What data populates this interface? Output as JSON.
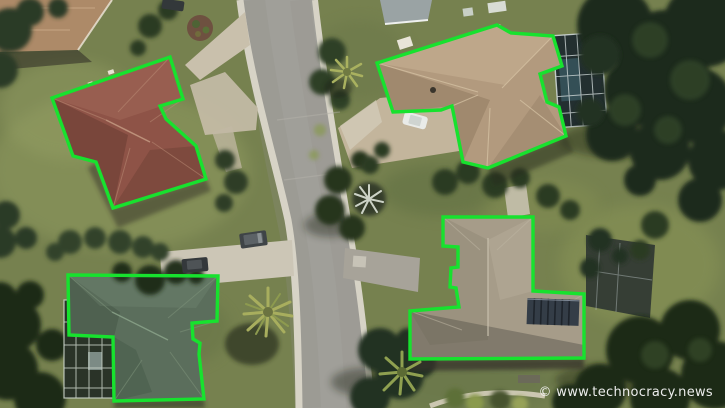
{
  "image": {
    "type": "aerial-photo",
    "subject": "Aerial satellite view of a suburban neighborhood; four house rooftops are outlined with bright green building-footprint detection polygons",
    "width": 725,
    "height": 408
  },
  "watermark": {
    "text": "© www.technocracy.news",
    "color": "#f7f7f7"
  },
  "detections": {
    "outline_color": "#17e22e",
    "buildings": [
      {
        "name": "building-top-left",
        "roof": "red-brown tile hip roof",
        "roof_color": "#8e5347",
        "points": "52,98 170,57 183,99 160,106 166,119 196,146 206,179 113,208 96,162 73,156"
      },
      {
        "name": "building-top-right",
        "roof": "tan shingle cross-hip roof",
        "roof_color": "#b29a7e",
        "points": "377,63 497,25 511,33 553,36 562,66 540,74 547,102 559,107 566,136 488,168 463,162 452,106 441,110 393,112"
      },
      {
        "name": "building-bottom-left",
        "roof": "dark green shingle roof",
        "roof_color": "#5b6e5c",
        "points": "68,275 218,276 217,321 192,323 193,339 200,343 199,354 204,399 114,401 113,337 69,335"
      },
      {
        "name": "building-bottom-right",
        "roof": "gray-tan shingle roof with solar panels",
        "roof_color": "#a69c89",
        "points": "443,217 533,217 533,291 584,294 584,358 410,359 410,311 459,307 456,288 450,287 451,268 458,267 458,247 443,246"
      }
    ]
  }
}
